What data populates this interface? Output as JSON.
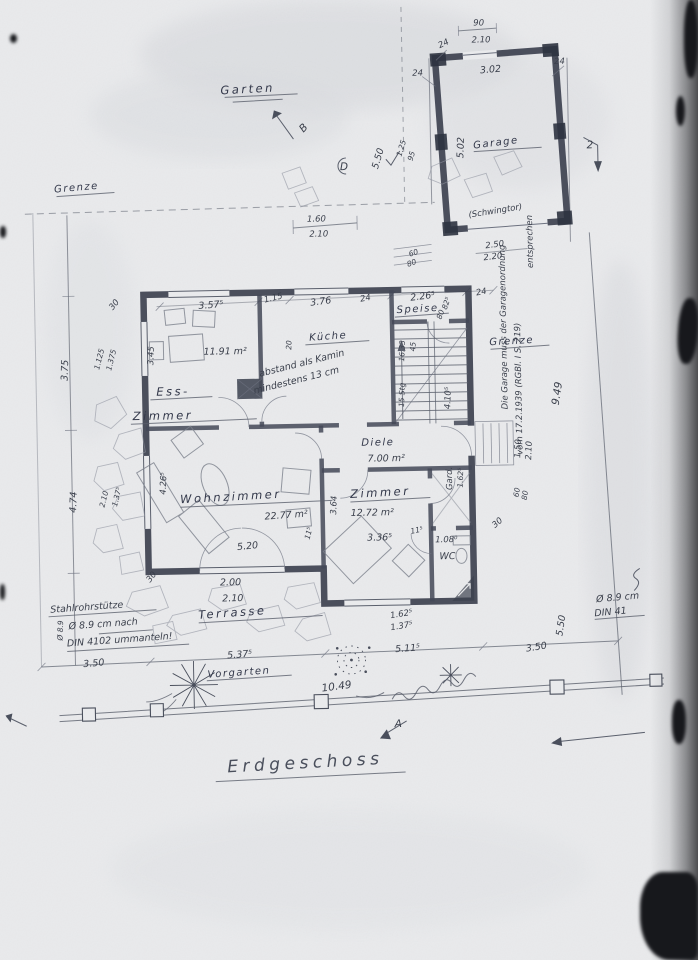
{
  "plan": {
    "title": "Erdgeschoss"
  },
  "site": {
    "garten": "Garten",
    "grenze_left": "Grenze",
    "grenze_right": "Grenze",
    "terrasse": "Terrasse",
    "vorgarten": "Vorgarten"
  },
  "rooms": {
    "ess1": "Ess-",
    "ess2": "Zimmer",
    "ess_area": "11.91 m²",
    "kueche": "Küche",
    "speise": "Speise",
    "diele": "Diele",
    "diele_area": "7.00 m²",
    "wohnzimmer": "Wohnzimmer",
    "wohnzimmer_area": "22.77 m²",
    "zimmer": "Zimmer",
    "zimmer_area": "12.72 m²",
    "gard": "Gard.",
    "wc": "WC"
  },
  "garage": {
    "label": "Garage",
    "door_label": "(Schwingtor)",
    "reg1": "Die Garage muss der Garagenordnung",
    "reg2": "vom 17.2.1939 (RGBl. I S. 219)",
    "reg3": "entsprechen"
  },
  "notes": {
    "kamin1": "abstand als Kamin",
    "kamin2": "mindestens 13 cm",
    "stuetze1": "Stahlrohrstütze",
    "stuetze2": "Ø 8.9 cm nach",
    "stuetze3": "DIN 4102 ummanteln!",
    "din_edge1": "Ø 8.9 cm",
    "din_edge2": "DIN 41"
  },
  "markers": {
    "a": "A",
    "b": "B",
    "d": "D",
    "two": "2"
  },
  "dims": {
    "garage_door_w": "90",
    "garage_door_h": "2.10",
    "garage_w": "3.02",
    "garage_d": "5.02",
    "g24a": "24",
    "g24b": "24",
    "g24c": "24",
    "gap_250": "2.50",
    "gap_220": "2.20",
    "grenze_949": "9.49",
    "garden_550": "5.50",
    "garden_125": "1.25",
    "garden_95": "95",
    "win_160": "1.60",
    "win_210": "2.10",
    "steps_60": "60",
    "steps_80": "80",
    "top_3575": "3.57⁵",
    "top_115": "1.15",
    "top_376": "3.76",
    "top_24a": "24",
    "top_2265": "2.26⁵",
    "top_24b": "24",
    "left_30a": "30",
    "left_375": "3.75",
    "left_1125": "1.125",
    "left_1375": "1.375",
    "left_345": "3.45",
    "left_474": "4.74",
    "left_210": "2.10",
    "left_1375b": "1.37⁵",
    "left_30b": "30",
    "left_4265": "4.26⁵",
    "kueche_20": "20",
    "speise_825": "82⁵",
    "speise_80": "80",
    "stairs_1633": "16.33",
    "stairs_45": "45",
    "stairs_15stg": "15 Stg",
    "stairs_4105": "4.10⁵",
    "entry_150": "1.50",
    "entry_210": "2.10",
    "entry_60": "60",
    "entry_80": "80",
    "right_30": "30",
    "wohn_520": "5.20",
    "wall_115a": "11⁵",
    "zimmer_364": "3.64",
    "zimmer_3365": "3.36⁵",
    "wall_115b": "11⁵",
    "gard_1625": "1.62⁵",
    "wc_108": "1.08⁰",
    "bot_200": "2.00",
    "bot_210": "2.10",
    "bot_1625": "1.62⁵",
    "bot_1375": "1.37⁵",
    "front_350l": "3.50",
    "front_5375": "5.37⁵",
    "front_5115": "5.11⁵",
    "front_350r": "3.50",
    "front_1049": "10.49",
    "front_550": "5.50",
    "margin_phi": "Ø 8.9"
  }
}
